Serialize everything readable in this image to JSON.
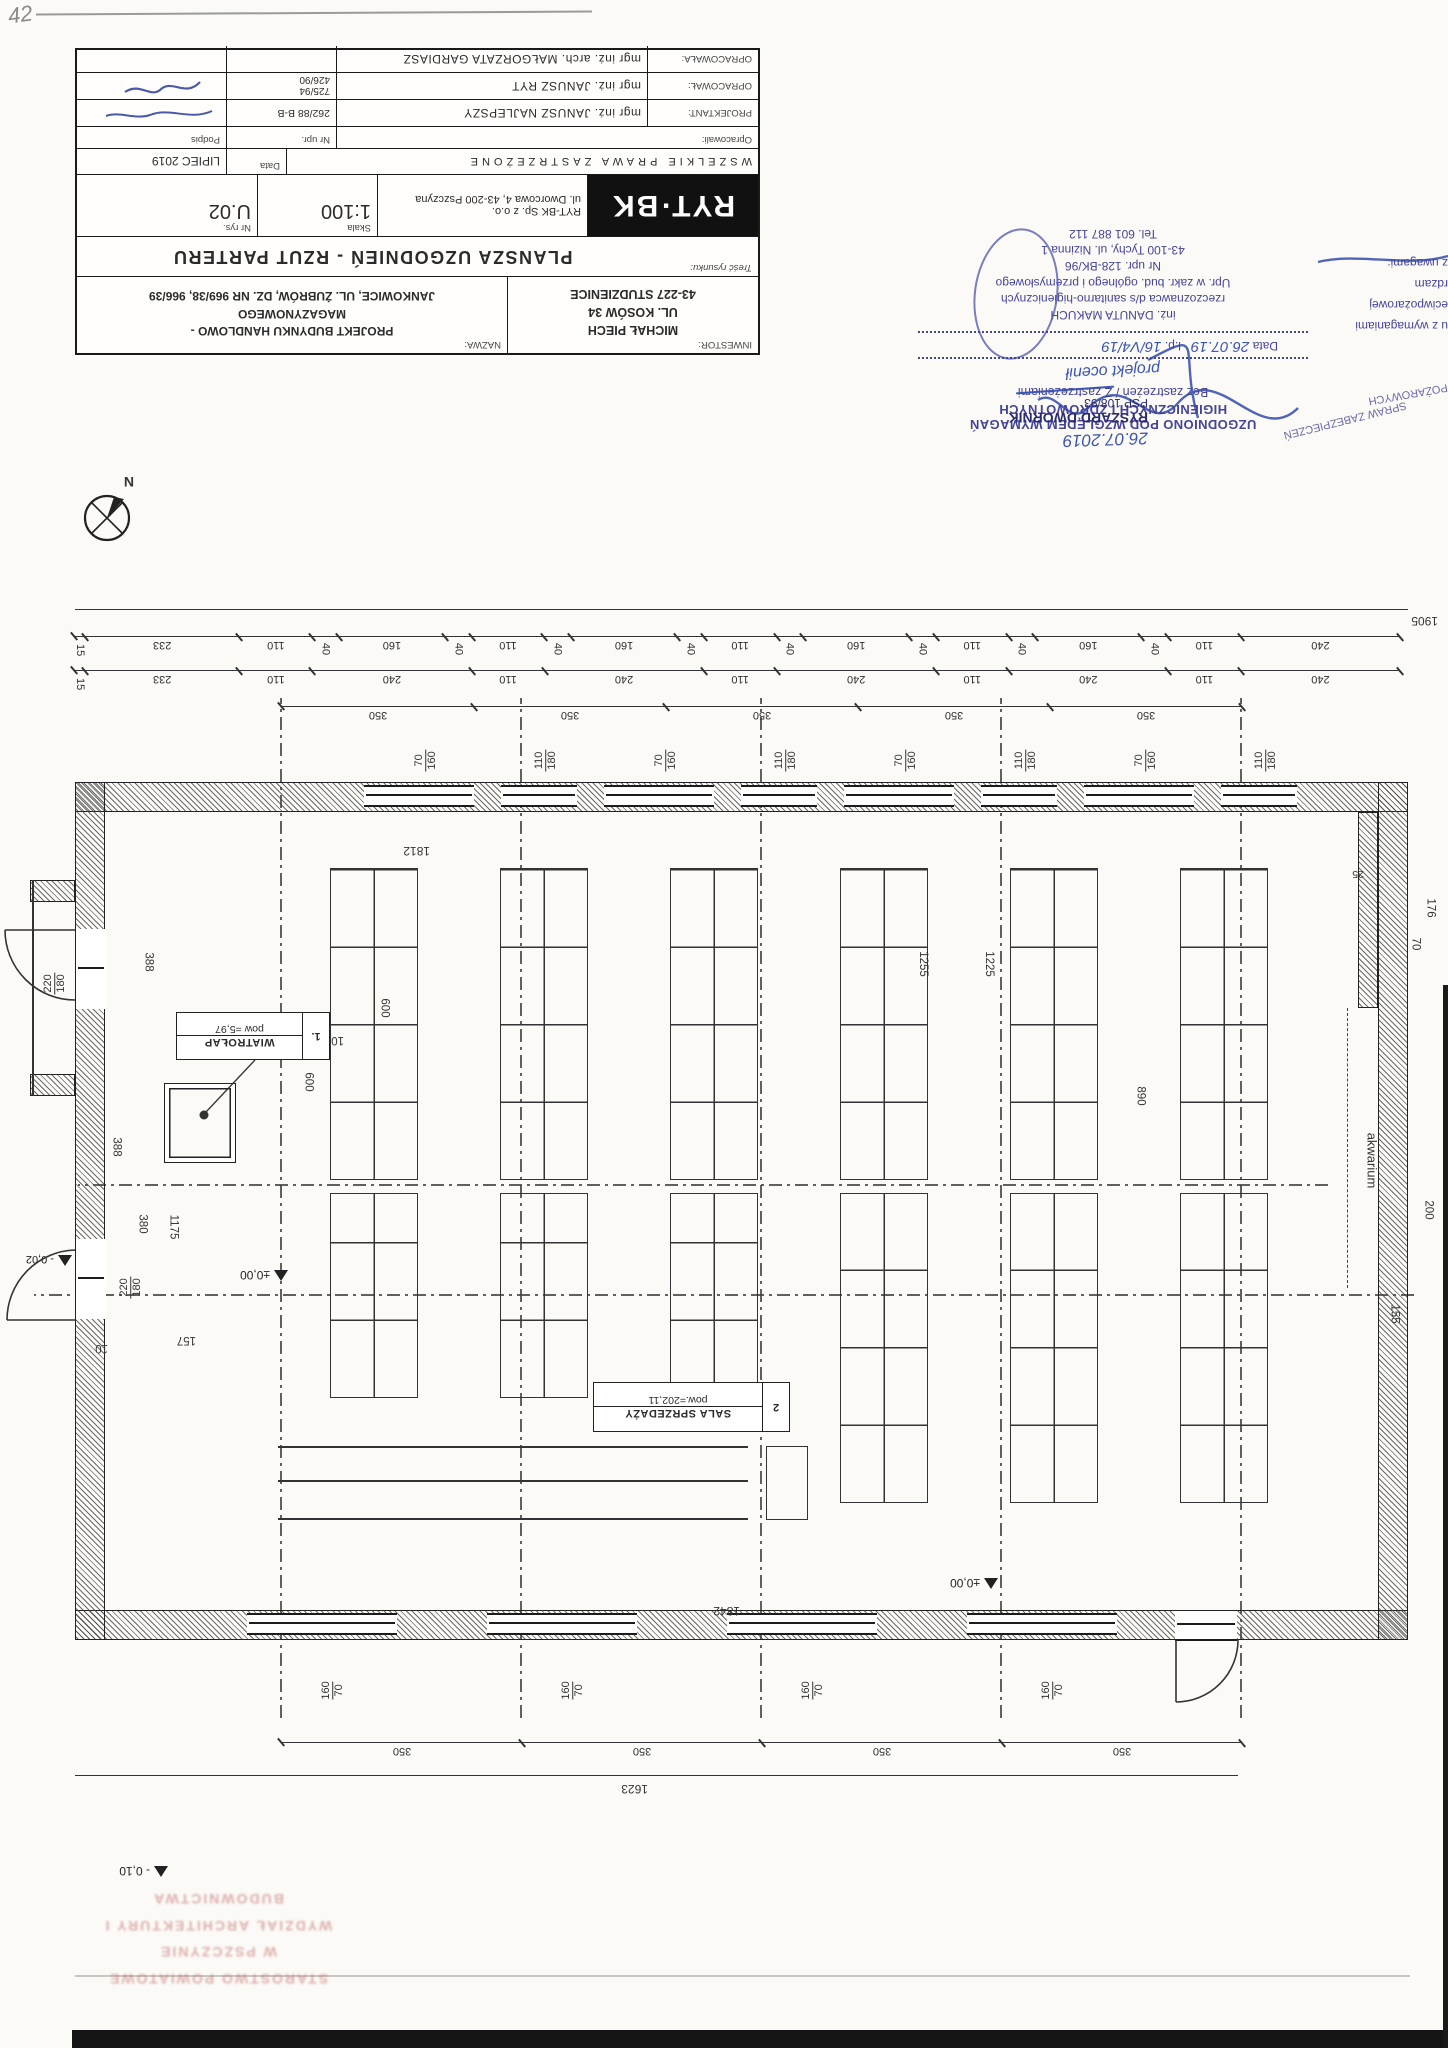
{
  "sheet": {
    "corner_note": "42"
  },
  "compass": {
    "label": "N"
  },
  "title_block": {
    "inwestor_label": "INWESTOR:",
    "inwestor_lines": [
      "MICHAŁ PIECH",
      "UL. KOSÓW 34",
      "43-227 STUDZIENICE"
    ],
    "nazwa_label": "NAZWA:",
    "nazwa_lines": [
      "PROJEKT BUDYNKU HANDLOWO -",
      "MAGAZYNOWEGO",
      "JANKOWICE, UL. ŻUBRÓW, DZ. NR 969/38, 966/39"
    ],
    "tresc_label": "Treść rysunku:",
    "drawing_title": "PLANSZA UZGODNIEŃ - RZUT PARTERU",
    "logo_text": "RYT·BK",
    "company_lines": [
      "RYT-BK Sp. z o.o.",
      "ul. Dworcowa 4, 43-200 Pszczyna"
    ],
    "skala_label": "Skala",
    "skala_value": "1:100",
    "nr_rys_label": "Nr rys.",
    "nr_rys_value": "U.02",
    "rights_notice": "WSZELKIE PRAWA ZASTRZEŻONE",
    "data_label": "Data",
    "data_value": "LIPIEC 2019",
    "opracowali_label": "Opracowali:",
    "nr_upr_label": "Nr upr.",
    "podpis_label": "Podpis",
    "people": [
      {
        "role": "PROJEKTANT:",
        "name": "mgr inż. JANUSZ NAJLEPSZY",
        "upr": "262/88 B-B"
      },
      {
        "role": "OPRACOWAŁ:",
        "name": "mgr inż. JANUSZ RYT",
        "upr": "725/94\n426/90"
      },
      {
        "role": "OPRACOWAŁA:",
        "name": "mgr inż. arch. MAŁGORZATA GARDIASZ",
        "upr": ""
      }
    ]
  },
  "stamps": {
    "fire_clause_fragments": [
      "u z wymaganiami",
      "eciwpożarowej",
      "rdzam",
      "z uwagami:"
    ],
    "sanitary": {
      "header1": "UZGODNIONO POD WZGLĘDEM WYMAGAŃ",
      "header2": "HIGIENICZNYCH I ZDROWOTNYCH",
      "option_left": "Bez zastrzeżeń",
      "option_sep": " / ",
      "option_right": "Z zastrzeżeniami",
      "handwritten_note": "projekt ocenił",
      "data_label": "Data",
      "data_value": "26.07.19",
      "lp_label": "l.p.",
      "lp_value": "16/V4/19",
      "expert_lines": [
        "inż. DANUTA MAKUCH",
        "rzeczoznawca d/s sanitarno-higienicznych",
        "Upr. w zakr. bud. ogólnego i przemysłowego",
        "Nr upr. 128-BK/96",
        "43-100 Tychy, ul. Nizinna 1",
        "Tel. 601 887 112"
      ]
    },
    "fire_expert": {
      "date_handwritten": "26.07.2019",
      "name": "RYSZARD DWORNIK",
      "id": "PSP 108/93",
      "fragment_a": "SPRAW ZABEZPIECZEŃ",
      "fragment_b": "POŻAROWYCH"
    }
  },
  "plan": {
    "rooms": {
      "wiatrolap_no": "1.",
      "wiatrolap_name": "WIATROŁAP",
      "wiatrolap_area": "pow =5,97",
      "sala_no": "2",
      "sala_name": "SALA SPRZEDAŻY",
      "sala_area": "pow.=202,11",
      "akwarium": "akwarium"
    },
    "levels": {
      "zero_entry": "±0,00",
      "minus2": "- 0,02",
      "zero_hall": "±0,00",
      "minus10": "- 0,10"
    },
    "totals": {
      "overall_width": "1905",
      "front_width": "1623",
      "inner_width_top": "1842",
      "inner_width_bottom": "1812"
    },
    "dim_rows": {
      "bottom_row1": [
        {
          "v": "240",
          "grow": 240
        },
        {
          "v": "110",
          "grow": 110
        },
        {
          "v": "40",
          "grow": 40,
          "rot": true
        },
        {
          "v": "160",
          "grow": 160
        },
        {
          "v": "40",
          "grow": 40,
          "rot": true
        },
        {
          "v": "110",
          "grow": 110
        },
        {
          "v": "40",
          "grow": 40,
          "rot": true
        },
        {
          "v": "160",
          "grow": 160
        },
        {
          "v": "40",
          "grow": 40,
          "rot": true
        },
        {
          "v": "110",
          "grow": 110
        },
        {
          "v": "40",
          "grow": 40,
          "rot": true
        },
        {
          "v": "160",
          "grow": 160
        },
        {
          "v": "40",
          "grow": 40,
          "rot": true
        },
        {
          "v": "110",
          "grow": 110
        },
        {
          "v": "40",
          "grow": 40,
          "rot": true
        },
        {
          "v": "160",
          "grow": 160
        },
        {
          "v": "40",
          "grow": 40,
          "rot": true
        },
        {
          "v": "110",
          "grow": 110
        },
        {
          "v": "233",
          "grow": 233
        },
        {
          "v": "15",
          "grow": 15,
          "rot": true
        }
      ],
      "bottom_row2": [
        {
          "v": "240",
          "grow": 240
        },
        {
          "v": "110",
          "grow": 110
        },
        {
          "v": "240",
          "grow": 240
        },
        {
          "v": "110",
          "grow": 110
        },
        {
          "v": "240",
          "grow": 240
        },
        {
          "v": "110",
          "grow": 110
        },
        {
          "v": "240",
          "grow": 240
        },
        {
          "v": "110",
          "grow": 110
        },
        {
          "v": "240",
          "grow": 240
        },
        {
          "v": "110",
          "grow": 110
        },
        {
          "v": "233",
          "grow": 233
        },
        {
          "v": "15",
          "grow": 15,
          "rot": true
        }
      ],
      "bottom_row3": [
        {
          "v": "350",
          "grow": 350
        },
        {
          "v": "350",
          "grow": 350
        },
        {
          "v": "350",
          "grow": 350
        },
        {
          "v": "350",
          "grow": 350
        },
        {
          "v": "350",
          "grow": 350
        }
      ],
      "top_row": [
        {
          "v": "350",
          "grow": 350
        },
        {
          "v": "350",
          "grow": 350
        },
        {
          "v": "350",
          "grow": 350
        },
        {
          "v": "350",
          "grow": 350
        }
      ]
    },
    "bottom_windows": [
      {
        "a": "110",
        "b": "180"
      },
      {
        "a": "70",
        "b": "160"
      },
      {
        "a": "110",
        "b": "180"
      },
      {
        "a": "70",
        "b": "160"
      },
      {
        "a": "110",
        "b": "180"
      },
      {
        "a": "70",
        "b": "160"
      },
      {
        "a": "110",
        "b": "180"
      },
      {
        "a": "70",
        "b": "160"
      }
    ],
    "top_windows": [
      {
        "a": "160",
        "b": "70"
      },
      {
        "a": "160",
        "b": "70"
      },
      {
        "a": "160",
        "b": "70"
      },
      {
        "a": "160",
        "b": "70"
      }
    ],
    "v_dims": {
      "d388a": "388",
      "d388b": "388",
      "d10a": "10",
      "d10b": "10",
      "d1175": "1175",
      "d380": "380",
      "d157": "157",
      "door1a": "220",
      "door1b": "180",
      "door2a": "220",
      "door2b": "180",
      "d1255": "1255",
      "d1225": "1225",
      "d600a": "600",
      "d600b": "600",
      "d890": "890",
      "d25": "25",
      "d176": "176",
      "d70": "70",
      "d200": "200",
      "d155": "155"
    }
  },
  "footer_stamp": {
    "lines": [
      "STAROSTWO POWIATOWE",
      "W PSZCZYNIE",
      "WYDZIAŁ ARCHITEKTURY I BUDOWNICTWA"
    ]
  }
}
